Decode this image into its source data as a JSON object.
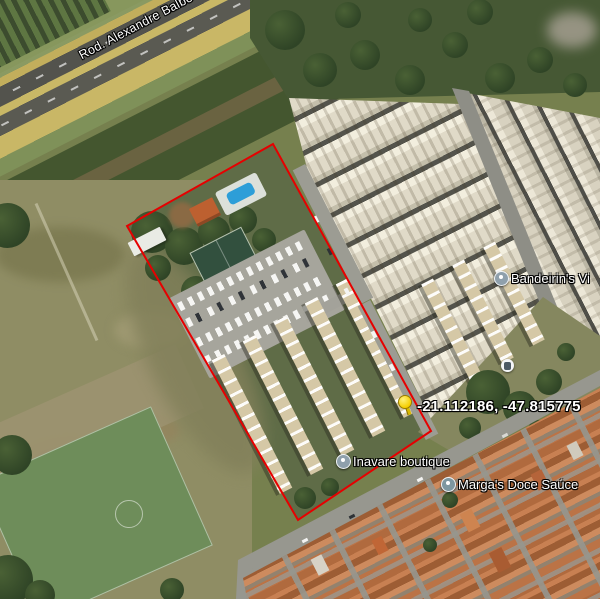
{
  "map": {
    "road_label": "Rod. Alexandre Balbo",
    "marker_coordinates": "-21.112186, -47.815775",
    "pois": [
      {
        "name": "Bandeirin's Vi"
      },
      {
        "name": "Inavare boutique"
      },
      {
        "name": "Marga's Doce Saúce"
      }
    ],
    "boundary_color": "#e60000",
    "pushpin_color": "#ffd800",
    "label_color": "#ffffff"
  }
}
